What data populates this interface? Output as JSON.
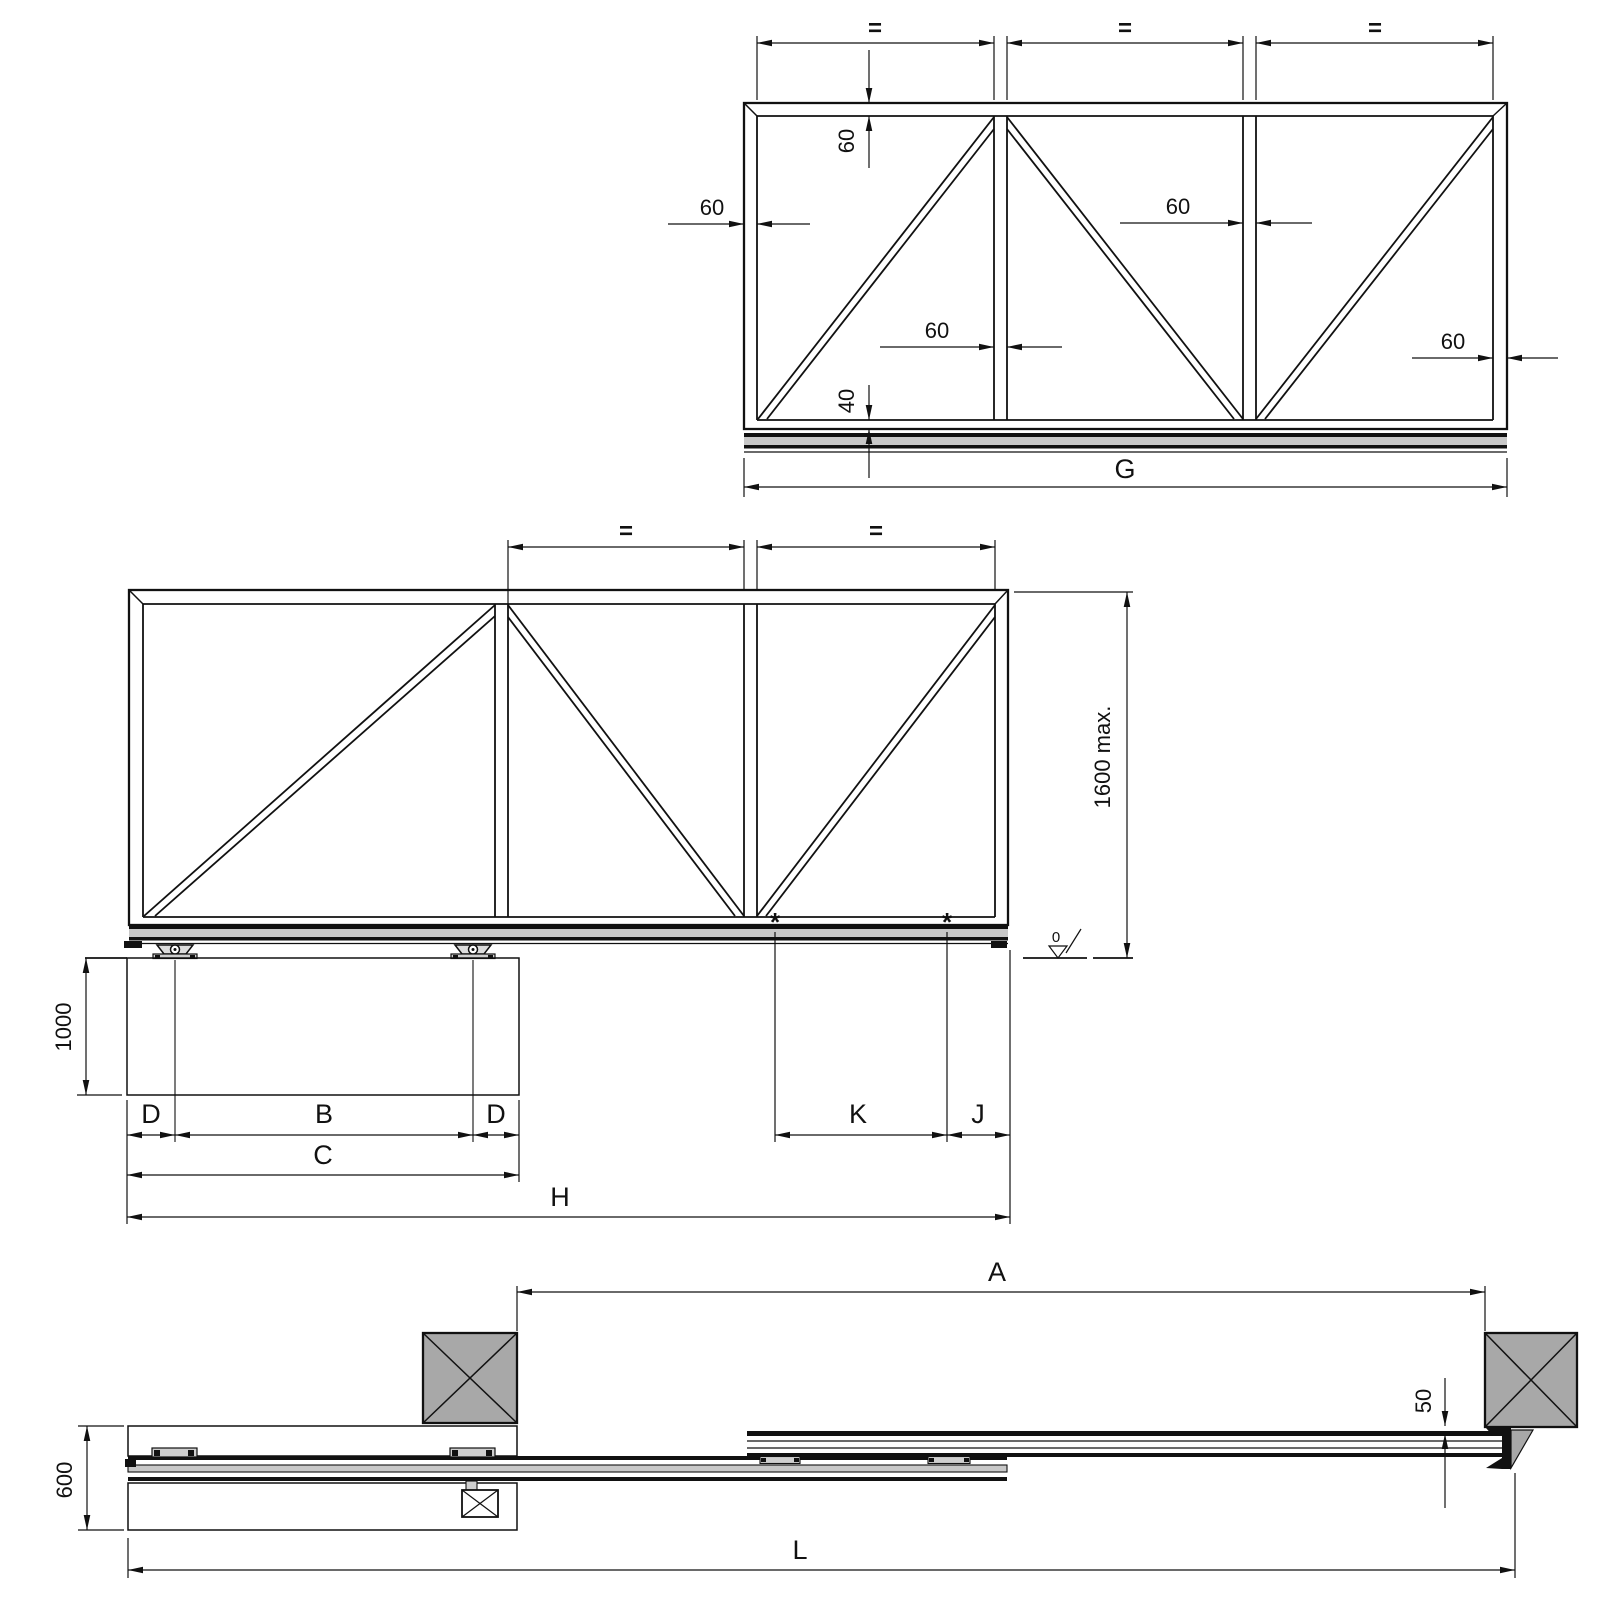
{
  "colors": {
    "line": "#111111",
    "bg": "#ffffff",
    "track-fill": "#c8c8c8",
    "post-fill": "#a8a8a8",
    "plate-fill": "#cfcfcf",
    "carriage-fill": "#dcdcdc"
  },
  "panel_view": {
    "equal_dims": [
      "=",
      "=",
      "="
    ],
    "top_rail_height": "60",
    "left_stile_width": "60",
    "mullion1_width": "60",
    "mullion2_width": "60",
    "right_stile_width": "60",
    "bottom_rail_height": "40",
    "overall_width_label": "G"
  },
  "elevation_view": {
    "equal_dims": [
      "=",
      "="
    ],
    "gate_height_label": "1600 max.",
    "datum_level_label": "0",
    "track_marker_left": "*",
    "track_marker_right": "*",
    "foundation_depth_label": "1000",
    "edge_offset_left_label": "D",
    "carriage_spacing_label": "B",
    "edge_offset_right_label": "D",
    "foundation_length_label": "C",
    "gate_total_length_label": "H",
    "cantilever_span_label": "K",
    "tail_overhang_label": "J"
  },
  "plan_view": {
    "clear_opening_label": "A",
    "overall_length_label": "L",
    "foundation_width_label": "600",
    "post_clearance_label": "50"
  }
}
